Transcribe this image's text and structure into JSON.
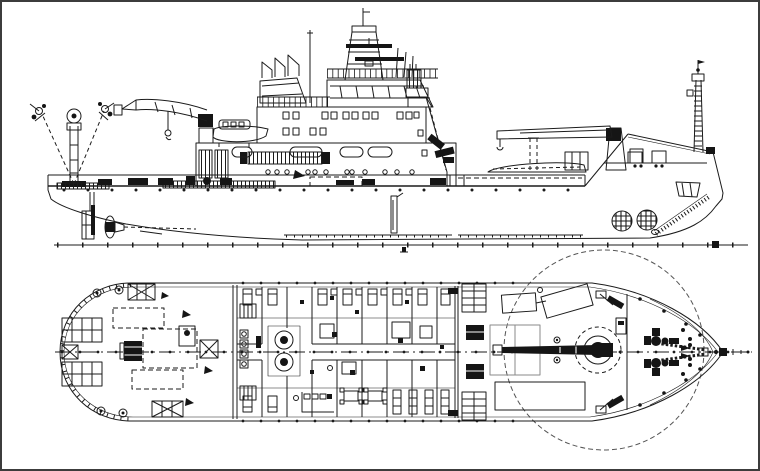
{
  "page": {
    "background": "#ffffff",
    "frame_border": "#3c3c3c"
  },
  "colors": {
    "line": "#1b1b1b",
    "dark_fill": "#151515",
    "muted": "#8a8a8a"
  },
  "drawing": {
    "subject": "research-vessel-general-arrangement",
    "views": [
      {
        "id": "side-elevation-profile",
        "components": [
          "baseline-with-stations",
          "hull-profile",
          "rudder-skeg-propeller",
          "drop-keel",
          "bilge-keel",
          "stern-a-frame",
          "aft-deck-fittings",
          "aft-deckhouse-vents",
          "aft-knuckle-crane",
          "rescue-boat",
          "superstructure",
          "boat-deck-railing",
          "wheelhouse",
          "aft-bridge-structure",
          "radar-mast",
          "funnel-casing",
          "davit-crane",
          "stowed-workboat",
          "foredeck-crane",
          "forecastle-gear",
          "bow-thruster-grilles",
          "anchor-chain",
          "foremast"
        ]
      },
      {
        "id": "main-deck-plan",
        "components": [
          "hull-outline",
          "centerline",
          "a-frame-foundations",
          "deck-hatches",
          "container-footprints",
          "deck-winch",
          "aft-deck-fittings-plan",
          "accommodation-block",
          "engine-casings",
          "stairways",
          "mess-seating",
          "foredeck",
          "crane-boom-rest-foundations",
          "foredeck-hatch",
          "deck-crane",
          "crane-working-radius",
          "windlass",
          "anchor-pockets",
          "bow-tip-fittings"
        ]
      }
    ]
  }
}
